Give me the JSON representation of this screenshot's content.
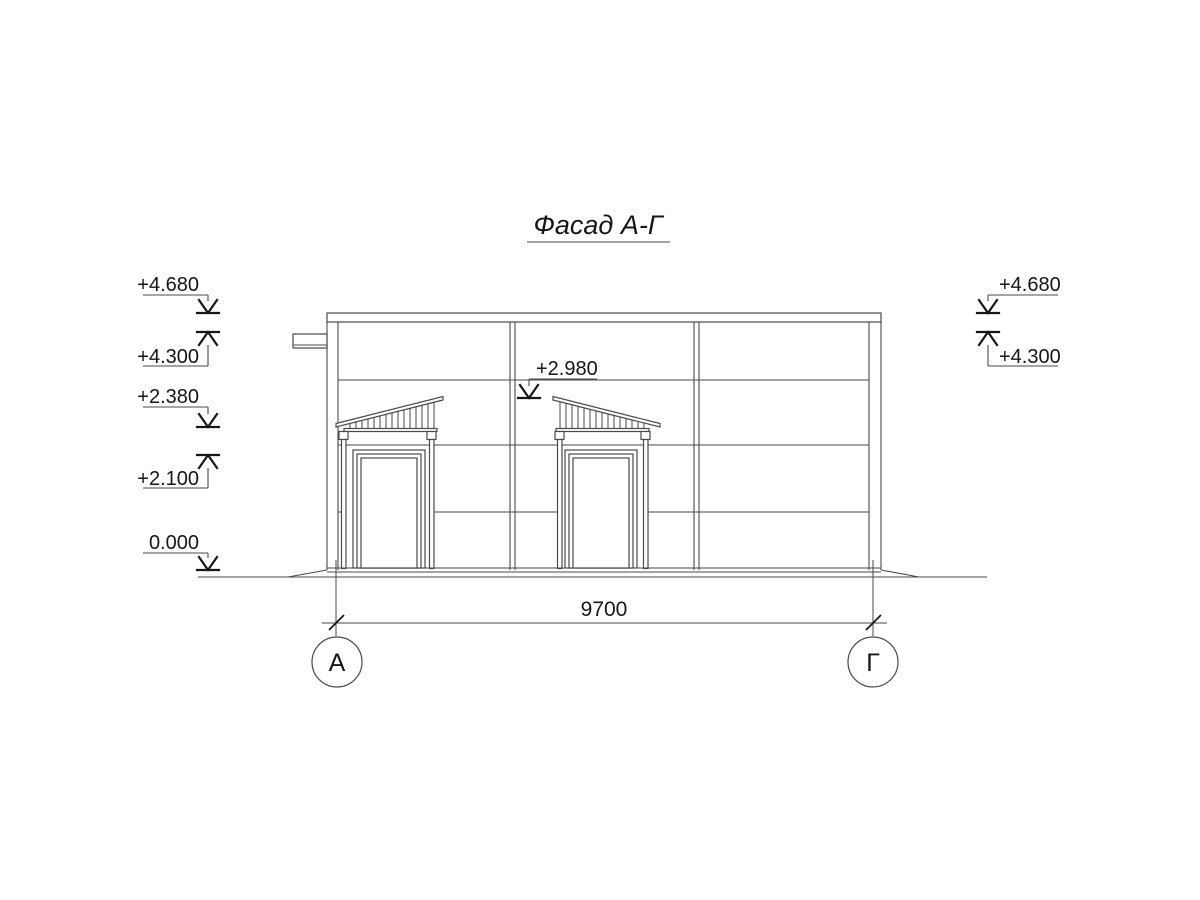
{
  "title": "Фасад А-Г",
  "colors": {
    "line": "#4a4a4a",
    "text": "#161616",
    "background": "#ffffff"
  },
  "elevations": {
    "left": [
      "+4.680",
      "+4.300",
      "+2.380",
      "+2.100",
      "0.000"
    ],
    "right": [
      "+4.680",
      "+4.300"
    ],
    "middle": "+2.980"
  },
  "dimension": {
    "length": "9700"
  },
  "axes": {
    "left": "А",
    "right": "Г"
  }
}
